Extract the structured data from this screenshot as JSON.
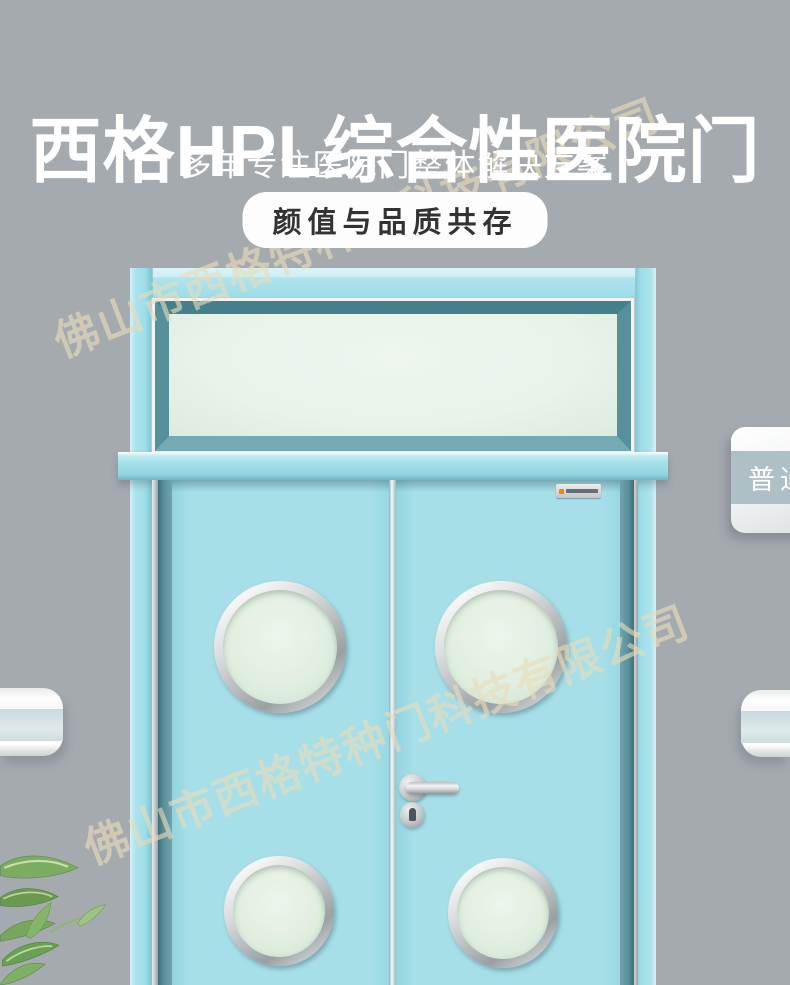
{
  "colors": {
    "background": "#a5aaaf",
    "frame_blue": "#9edce8",
    "leaf_blue": "#a7dfe9",
    "reveal_teal": "#5d929d",
    "bevel_teal": "#44808c",
    "transom_glass": "#e8f3ea",
    "porthole_glass": "#e0efe0",
    "watermark": "rgba(233,219,186,0.62)",
    "badge_bg": "#fdfdfd",
    "badge_text": "#333333",
    "sign_band": "#aebfc5",
    "text_white": "#ffffff"
  },
  "header": {
    "title": "西格HPL综合性医院门",
    "subtitle": "多年专注医院门整体解决方案",
    "badge": "颜值与品质共存"
  },
  "watermark": {
    "text": "佛山市西格特种门科技有限公司"
  },
  "door_sign": {
    "label": "普通"
  }
}
